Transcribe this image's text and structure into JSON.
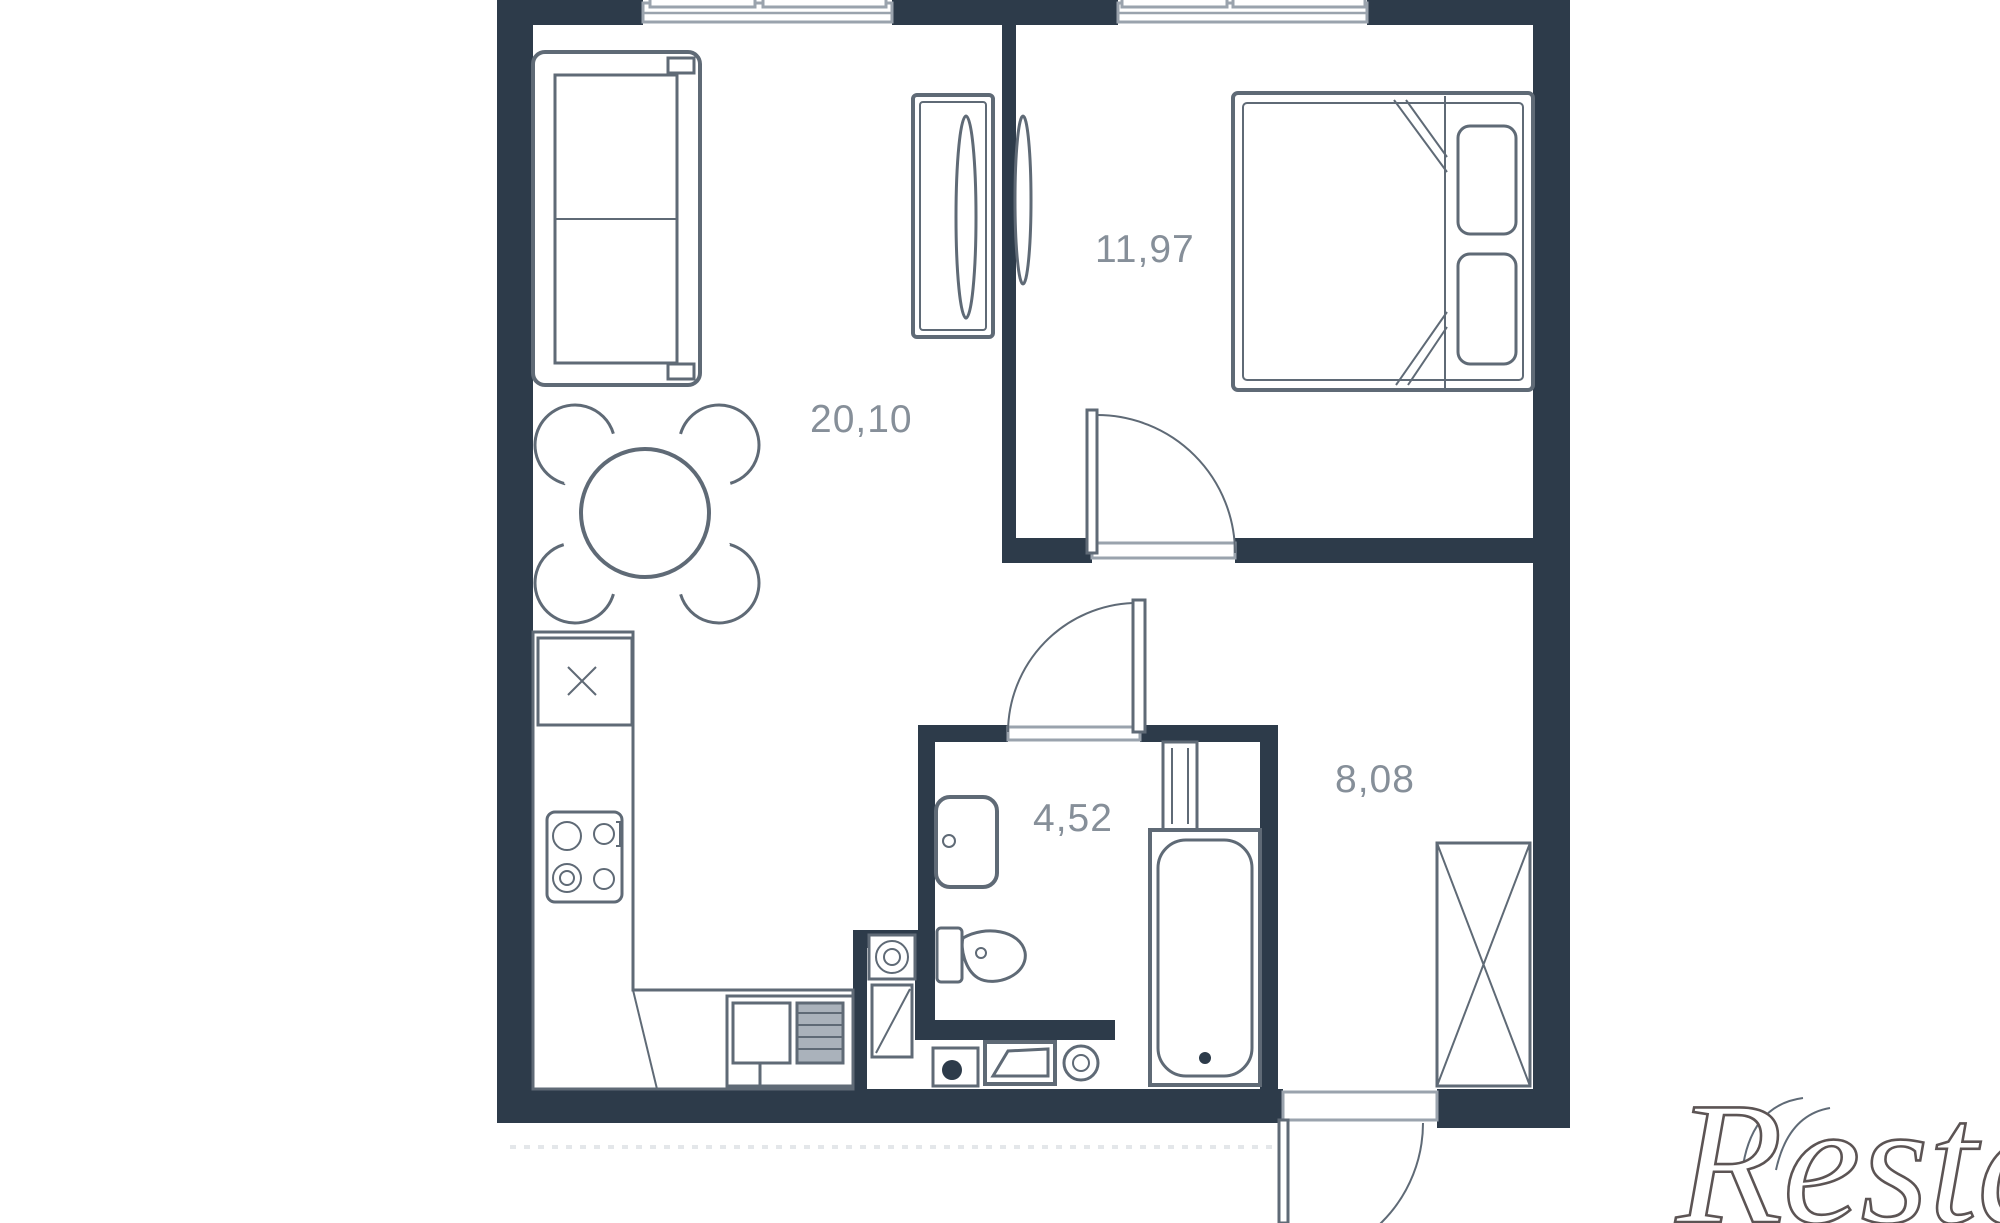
{
  "page": {
    "background": "#ffffff"
  },
  "floorplan": {
    "type": "apartment-floor-plan",
    "wall_color": "#2d3b4a",
    "line_color": "#5f6a76",
    "label_color": "#868f99",
    "rooms": [
      {
        "id": "living-kitchen",
        "area_label": "20,10"
      },
      {
        "id": "bedroom",
        "area_label": "11,97"
      },
      {
        "id": "bathroom",
        "area_label": "4,52"
      },
      {
        "id": "hallway",
        "area_label": "8,08"
      }
    ],
    "fixtures": [
      "sofa",
      "dining-table",
      "dining-chairs",
      "tv-console",
      "bedroom-wall-tv",
      "double-bed",
      "pillows",
      "kitchen-counter",
      "kitchen-cabinet-x",
      "cooktop",
      "kitchen-sink-drainer",
      "bathroom-sink",
      "toilet",
      "bathtub",
      "shower-column",
      "washing-machine",
      "water-heater",
      "laundry-closet",
      "wardrobe-x",
      "window-living",
      "window-bedroom",
      "door-bedroom",
      "door-bathroom",
      "door-entry"
    ]
  },
  "watermark": {
    "text": "Restate"
  }
}
